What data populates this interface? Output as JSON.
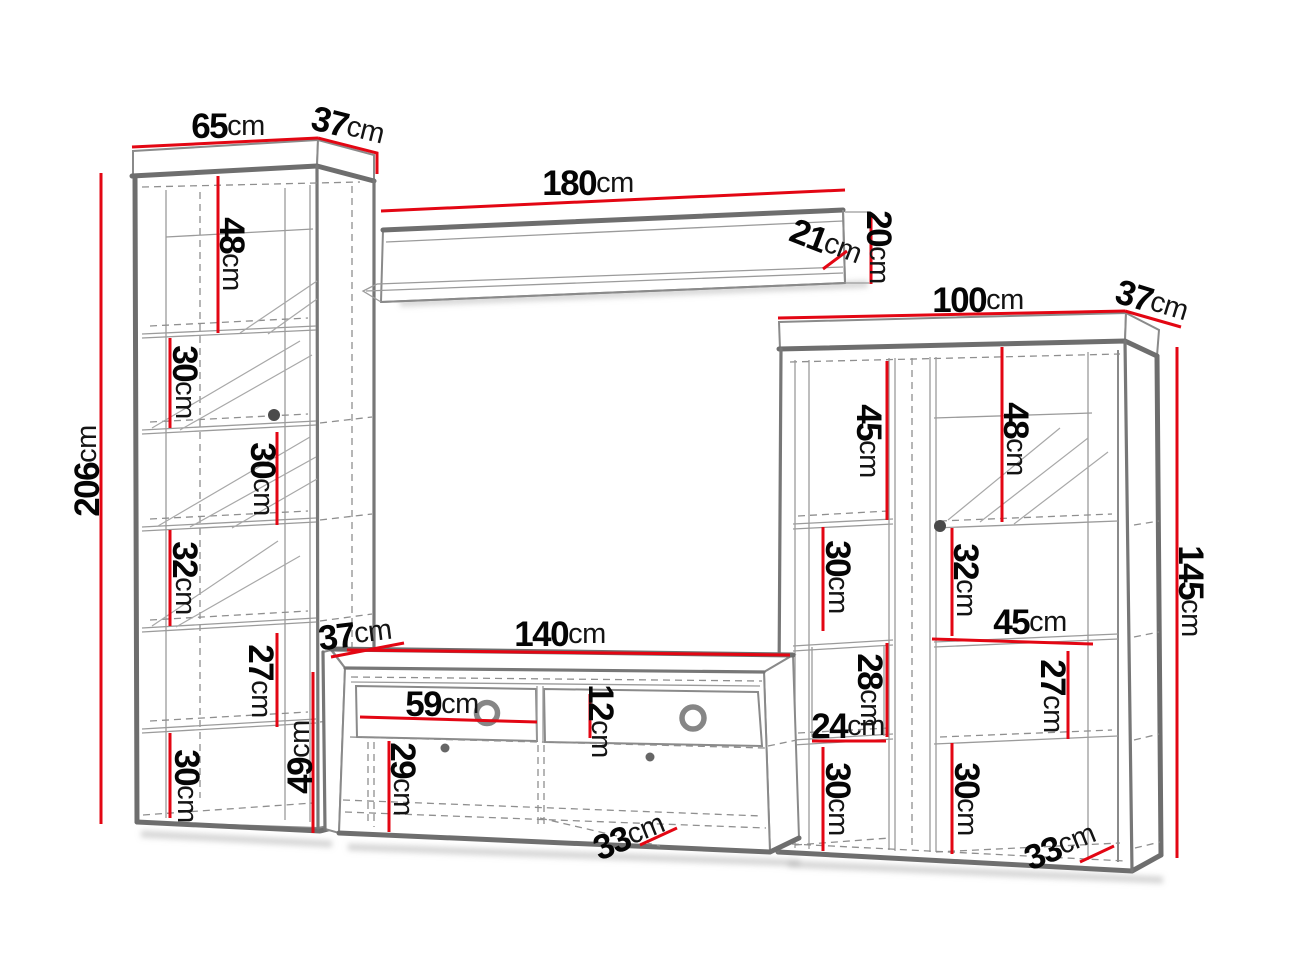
{
  "unit": "cm",
  "palette": {
    "dimension_red": "#e30613",
    "outline_gray": "#6e6e6e",
    "text_black": "#050505"
  },
  "left_cabinet": {
    "width": "65",
    "depth": "37",
    "height": "206",
    "section1_height": "48",
    "section2_height": "30",
    "section3_height": "30",
    "section4_height": "32",
    "section5_height": "27",
    "section6_height": "30"
  },
  "wall_shelf": {
    "length": "180",
    "depth": "21",
    "height": "20"
  },
  "tv_stand": {
    "width": "140",
    "depth": "37",
    "height": "49",
    "drawer_width": "59",
    "drawer_front_height": "12",
    "compartment_height": "29",
    "base_depth": "33"
  },
  "right_cabinet": {
    "width": "100",
    "depth": "37",
    "height": "145",
    "left_section1_height": "45",
    "left_section2_height": "30",
    "niche_height": "28",
    "niche_width": "24",
    "left_section3_height": "30",
    "right_section1_height": "48",
    "right_section2_height": "32",
    "shelf_width": "45",
    "right_section3_height": "27",
    "right_section4_height": "30",
    "base_depth": "33"
  }
}
